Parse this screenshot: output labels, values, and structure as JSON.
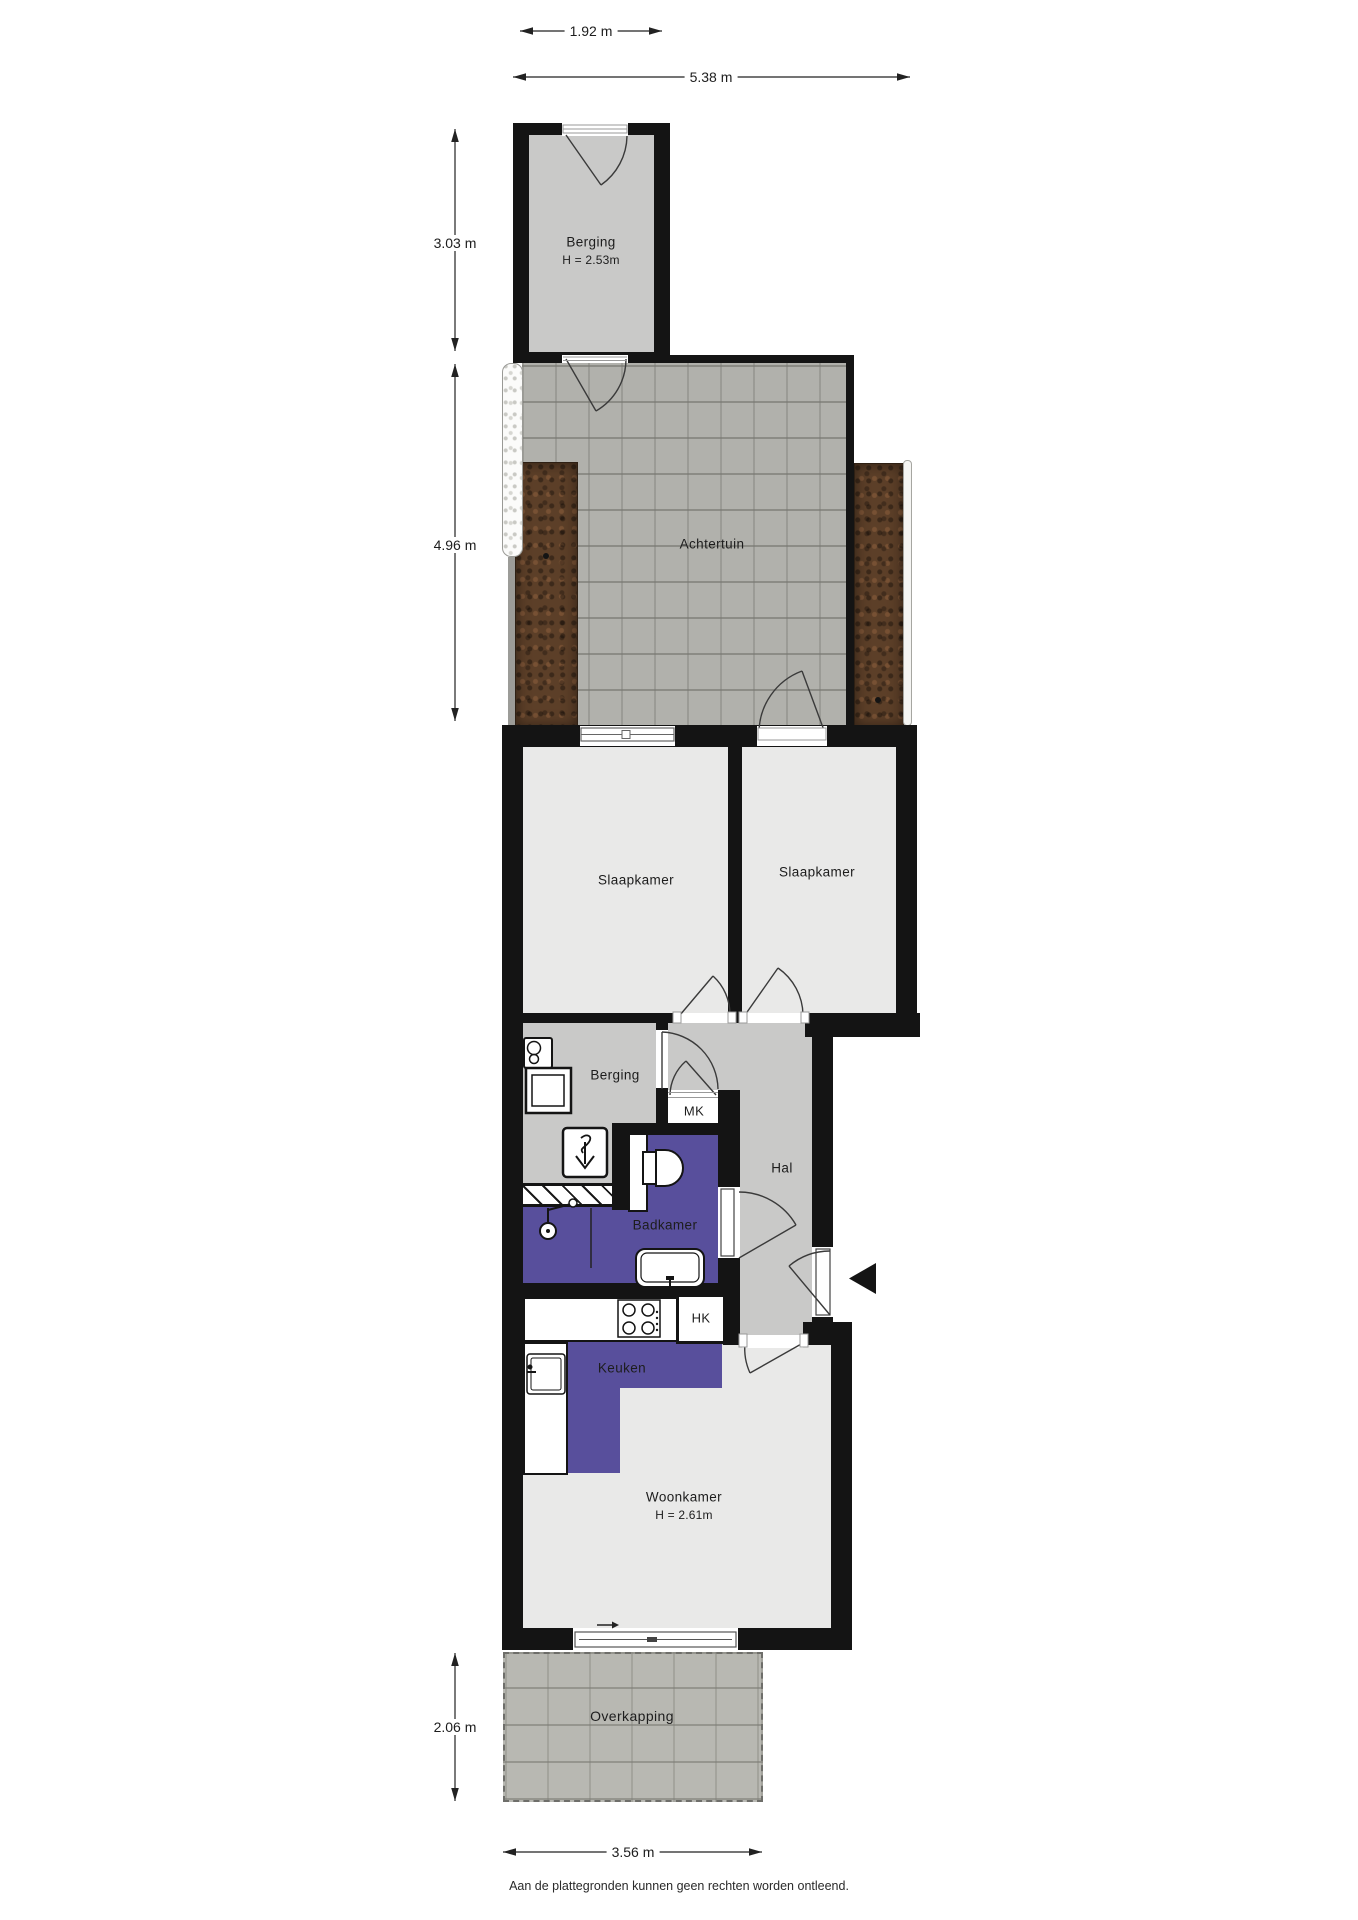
{
  "dimensions": {
    "shed_width": "1.92 m",
    "garden_width": "5.38 m",
    "shed_depth": "3.03 m",
    "garden_depth": "4.96 m",
    "canopy_depth": "2.06 m",
    "canopy_width": "3.56 m"
  },
  "rooms": {
    "shed": {
      "label": "Berging",
      "height": "H = 2.53m"
    },
    "garden": {
      "label": "Achtertuin"
    },
    "bedroom_left": {
      "label": "Slaapkamer"
    },
    "bedroom_right": {
      "label": "Slaapkamer"
    },
    "storage": {
      "label": "Berging"
    },
    "hall": {
      "label": "Hal"
    },
    "meter_cupboard": {
      "label": "MK"
    },
    "bathroom": {
      "label": "Badkamer"
    },
    "utility_cupboard": {
      "label": "HK"
    },
    "kitchen": {
      "label": "Keuken"
    },
    "living_room": {
      "label": "Woonkamer",
      "height": "H = 2.61m"
    },
    "canopy": {
      "label": "Overkapping"
    }
  },
  "footer": {
    "disclaimer": "Aan de plattegronden kunnen geen rechten worden ontleend."
  },
  "colors": {
    "wall": "#141414",
    "floor_light": "#e9e9e8",
    "floor_mid": "#c9c9c8",
    "accent_purple": "#584f9c",
    "pavement": "#b1b1ac",
    "soil": "#5c3f28"
  }
}
